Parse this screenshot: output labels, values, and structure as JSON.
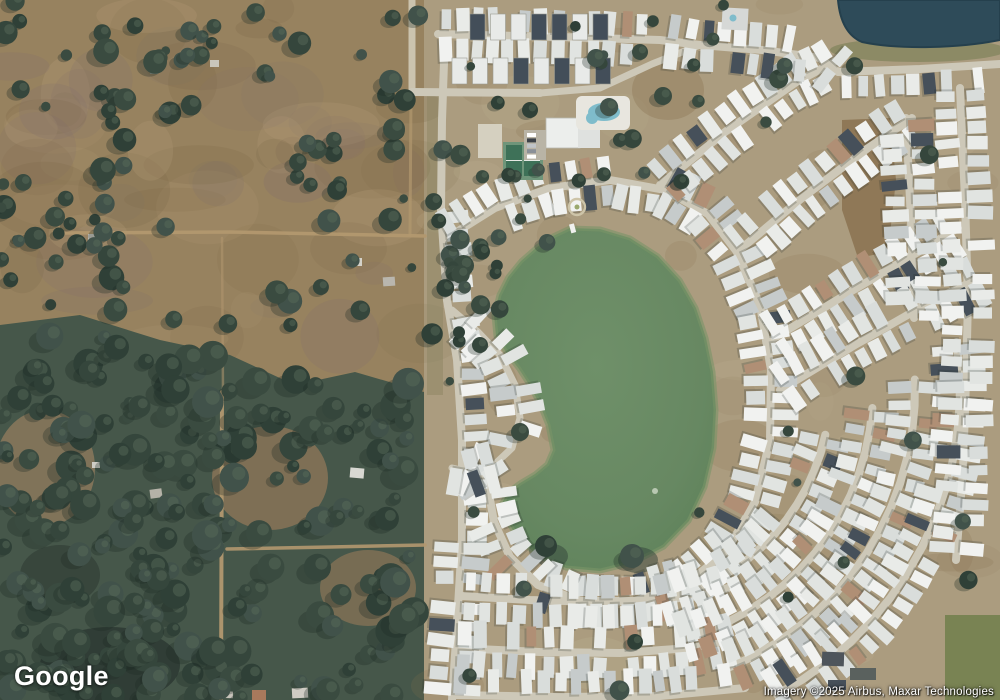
{
  "map": {
    "logo_text": "Google",
    "attribution_text": "Imagery ©2025 Airbus, Maxar Technologies",
    "view_type": "satellite",
    "features": {
      "left": "rural wooded parcels and open fields",
      "center": "retention lake inside mobile-home community",
      "right": "mobile-home park with curved streets",
      "top_right": "small dark pond",
      "top_center": "clubhouse, swimming pool, tennis courts"
    },
    "colors": {
      "rural_field": "#97825f",
      "rural_field_dark": "#7c6749",
      "rural_field_light": "#b39c77",
      "rural_mauve": "#85726b",
      "forest": "#46574a",
      "forest_dark": "#2e3b34",
      "dev_ground": "#ab9c7f",
      "dev_ground_dark": "#8a7250",
      "street": "#cdc8b8",
      "dirt_road": "#b2986f",
      "home_white": "#eef0ee",
      "home_gray": "#c6cbcb",
      "home_dark": "#46505a",
      "home_tan": "#b08f75",
      "lake": "#678862",
      "lake_edge": "#7a9468",
      "pond": "#2e4b59",
      "pool": "#7fbccb",
      "court": "#3e7158",
      "court_apron": "#6f957a",
      "green_field": "#73814f"
    }
  }
}
